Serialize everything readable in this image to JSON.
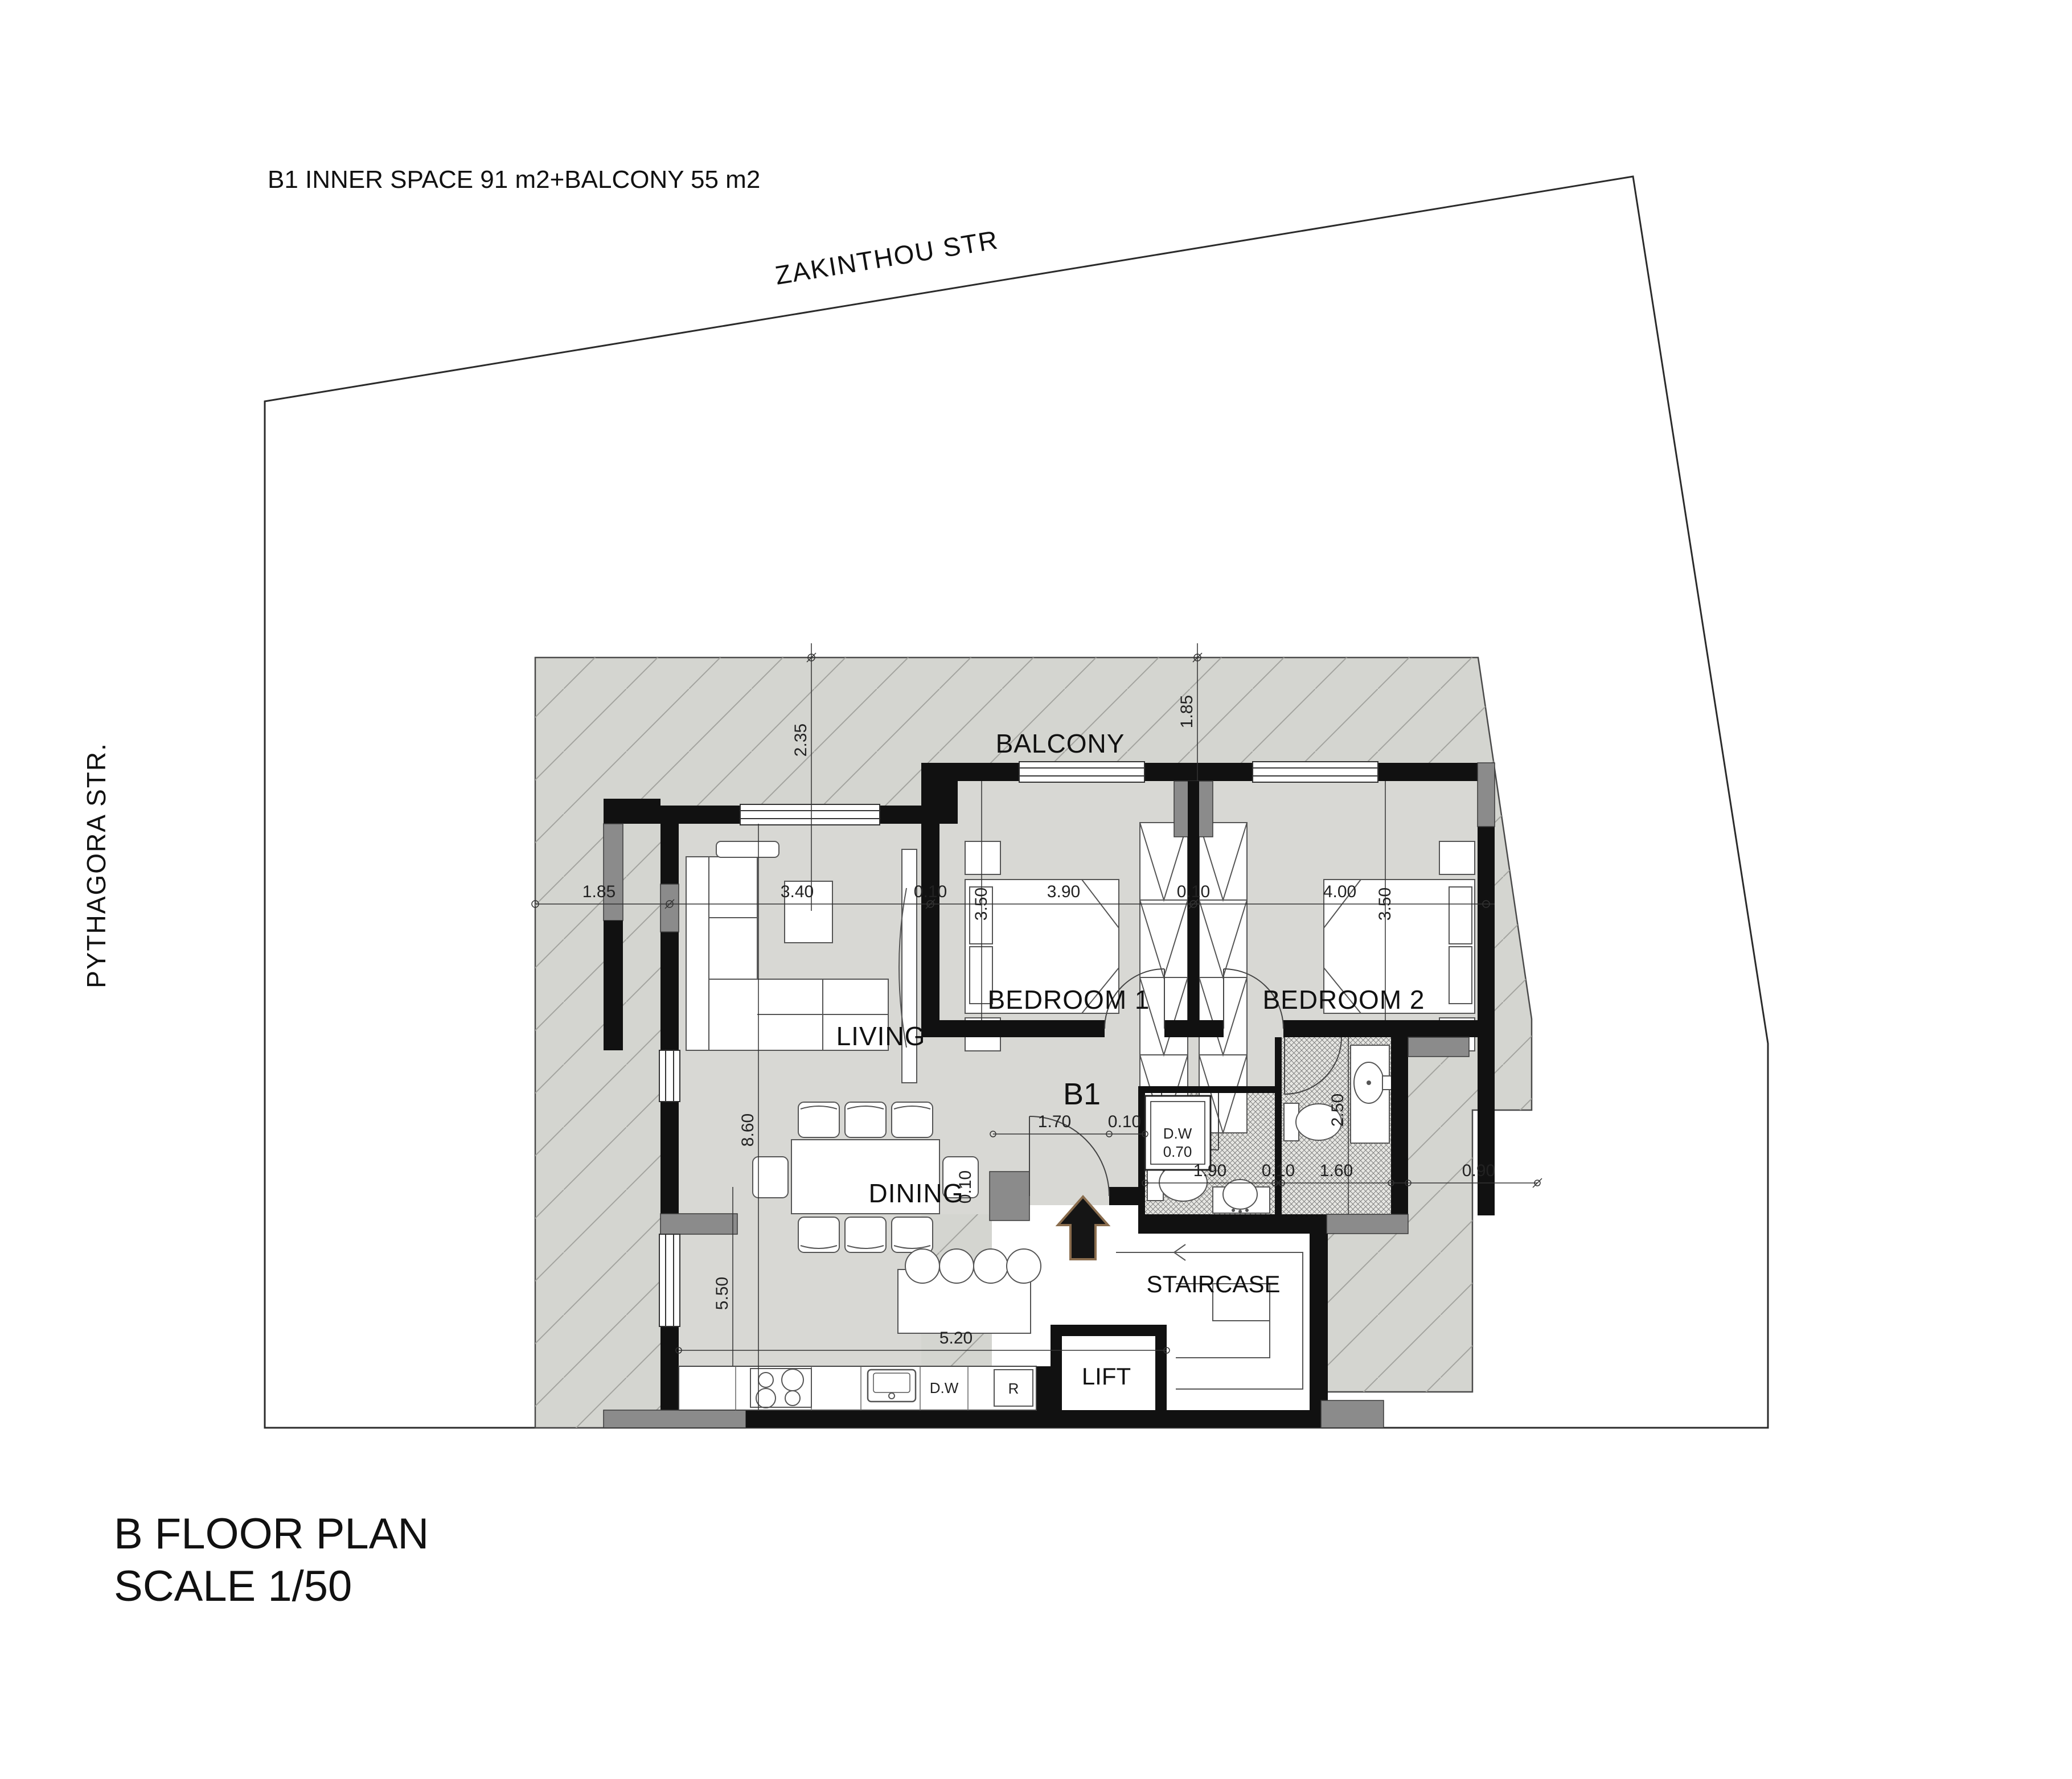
{
  "header": {
    "title": "B1 INNER SPACE 91  m2+BALCONY 55  m2"
  },
  "streets": {
    "top": "ZAKINTHOU STR",
    "left": "PYTHAGORA STR."
  },
  "footer": {
    "line1": "B FLOOR PLAN",
    "line2": "SCALE 1/50"
  },
  "unit": {
    "label": "B1"
  },
  "rooms": {
    "balcony": "BALCONY",
    "living": "LIVING",
    "dining": "DINING",
    "bedroom1": "BEDROOM 1",
    "bedroom2": "BEDROOM 2",
    "staircase": "STAIRCASE",
    "lift": "LIFT"
  },
  "kitchen": {
    "dishwasher": "D.W",
    "fridge": "R"
  },
  "closet": {
    "name": "D.W",
    "size": "0.70"
  },
  "dims": {
    "balcony_top_depth": "2.35",
    "balcony_left_width": "1.85",
    "balcony_bed_depth": "1.85",
    "living_width": "3.40",
    "wall_a": "0.10",
    "bed1_depth": "3.50",
    "bed1_width": "3.90",
    "wall_b": "0.10",
    "bed2_width": "4.00",
    "bed2_depth": "3.50",
    "apt_height": "8.60",
    "dining_height": "5.50",
    "dining_width": "5.20",
    "hall_width": "1.70",
    "wall_c": "0.10",
    "bath1_width": "1.90",
    "wall_d": "0.10",
    "bath2_width": "1.60",
    "edge_offset": "0.90",
    "bath2_depth": "2.50",
    "wall_e": "0.10"
  },
  "colors": {
    "slab": "#d4d5d0",
    "interior": "#d8d8d4",
    "wall": "#111111",
    "pier": "#8b8b8b",
    "hatch": "#a3a39f",
    "tile_bg": "#e6e6e2"
  }
}
